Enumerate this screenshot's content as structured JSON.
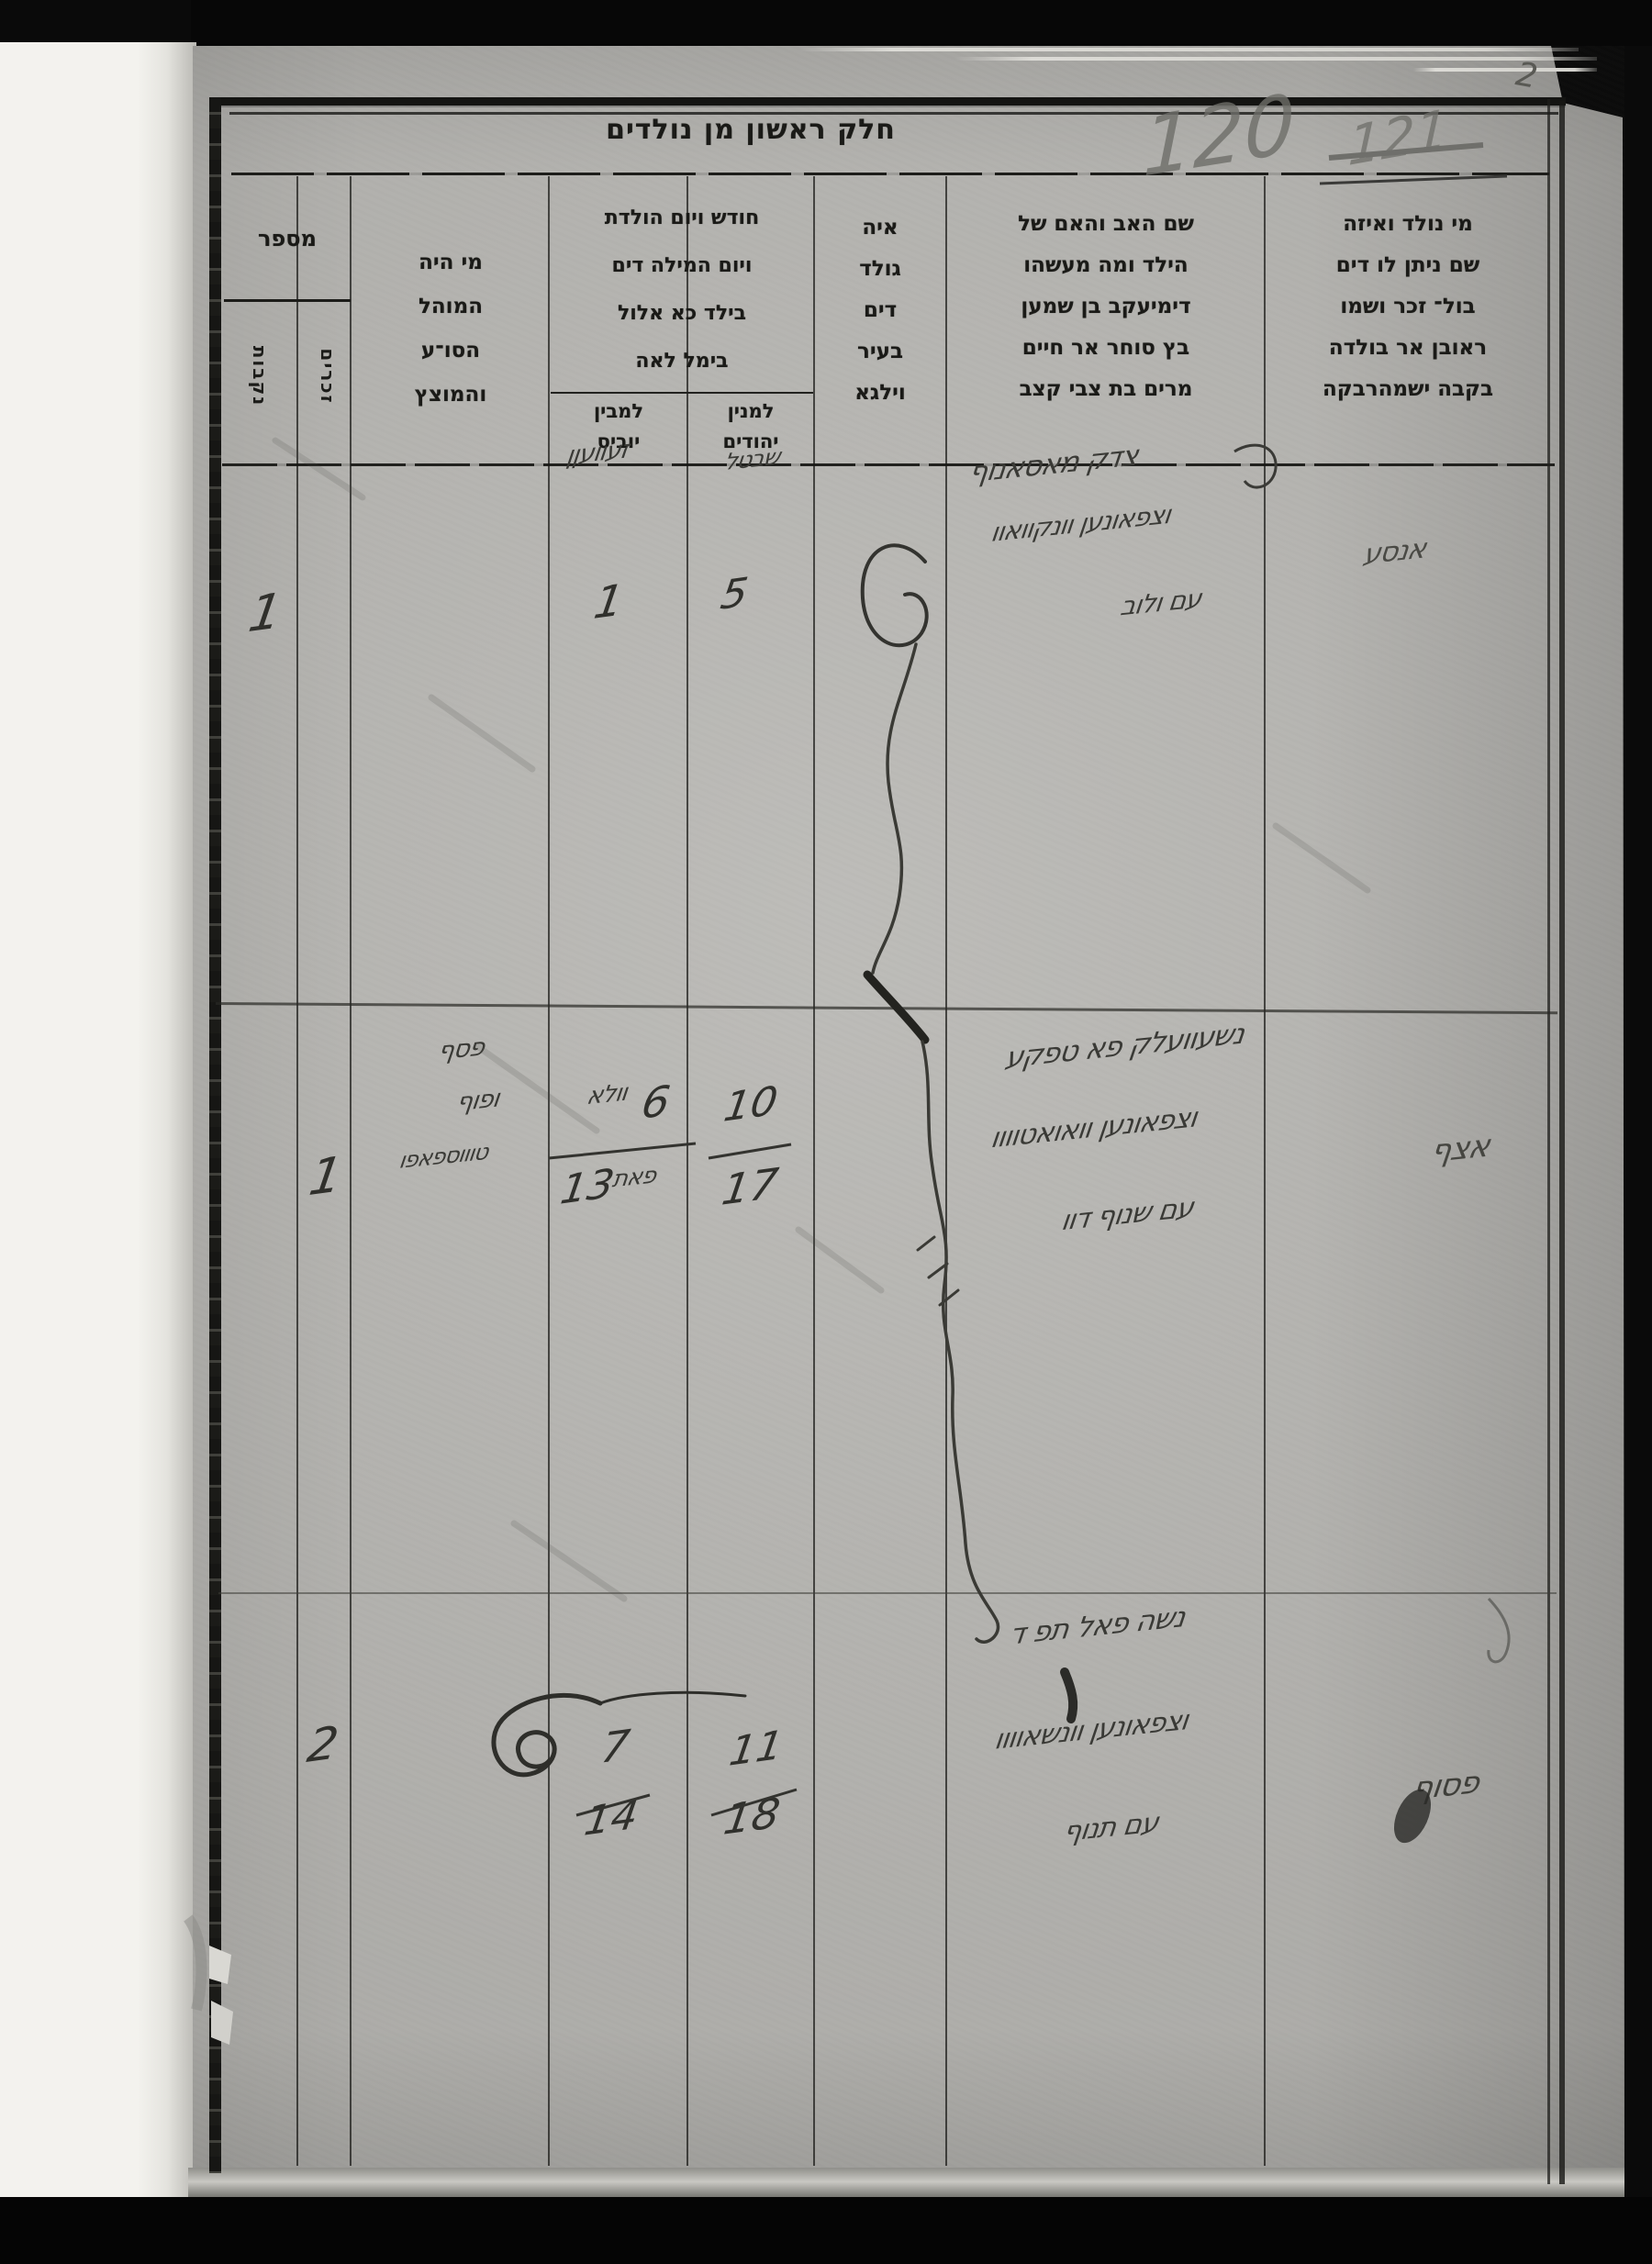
{
  "page": {
    "corner_page_number": "2",
    "title": "חלק ראשון מן נולדים",
    "folio_number": "120",
    "folio_number_crossed_out": "121"
  },
  "headers": {
    "child": {
      "lines": [
        "מי נולד ואיזה",
        "שם ניתן לו דים",
        "בול־ זכר ושמו",
        "ראובן אר בולדה",
        "בקבה ישמהרבקה"
      ]
    },
    "parents": {
      "lines": [
        "שם האב והאם של",
        "הילד ומה מעשהו",
        "דימיעקב בן שמען",
        "בץ סוחר אר חיים",
        "מרים בת צבי קצב"
      ]
    },
    "where": {
      "lines": [
        "איה",
        "גולד",
        "דים",
        "בעיר",
        "וילגא"
      ]
    },
    "date": {
      "lines": [
        "חודש ויום הולדת",
        "ויום המילה דים",
        "בילד כא אלול",
        "בימל לאה"
      ],
      "sub_jewish": {
        "lines": [
          "למנין",
          "יהודים"
        ]
      },
      "sub_civil": {
        "lines": [
          "למבין",
          "יוביס"
        ]
      }
    },
    "mohel": {
      "lines": [
        "מי היה",
        "המוהל",
        "הסו־ע",
        "והמוצץ"
      ]
    },
    "number": {
      "label": "מספר",
      "male_sub": "זכרים",
      "female_sub": "נקבות"
    }
  },
  "rows": [
    {
      "female_count": "1",
      "civil_month_word": "זעוועןן",
      "civil_day": "1",
      "jewish_month_word": "שבטל",
      "jewish_day": "5",
      "parents_line1": "צדק מאסאנוף",
      "parents_line2": "וצפאונען וונקוואוו",
      "parents_line3": "עם ולוב",
      "margin_note": "אנסע"
    },
    {
      "male_count": "1",
      "mohel_line1": "פסף",
      "mohel_line2": "ופוף",
      "mohel_line3": "טוווספאפו",
      "civil_word_top": "וולא",
      "civil_birth_day": "6",
      "civil_word_bottom": "פאת",
      "civil_bris_day": "13",
      "jewish_birth_day": "10",
      "jewish_bris_day": "17",
      "parents_line1": "נשעוועלק פא טפקע",
      "parents_line2": "וצפאונען וואואטוווו",
      "parents_line3": "עם שנוף דוו",
      "margin_note": "אצף"
    },
    {
      "male_count": "2",
      "civil_birth_day": "7",
      "civil_bris_day": "14",
      "jewish_birth_day": "11",
      "jewish_bris_day": "18",
      "parents_line1": "נשה פאל תפ ד",
      "parents_line2": "וצפאונען וונשאוווו",
      "parents_line3": "עם תנוף",
      "margin_note": "פסוף",
      "corner_note_rows23": ""
    }
  ],
  "colors": {
    "paper": "#b6b5b1",
    "ink": "#1a1a17",
    "handwriting": "#3a3a36",
    "pencil": "#6e6e69",
    "scanner_bg": "#0a0a0a"
  }
}
